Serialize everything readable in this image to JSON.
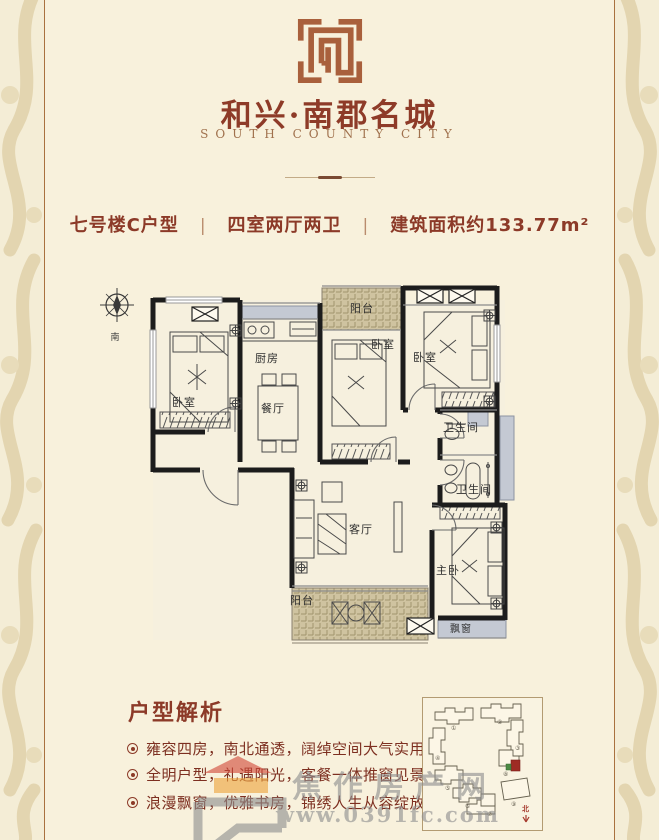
{
  "header": {
    "title": "和兴·南郡名城",
    "subtitle": "SOUTH COUNTY CITY"
  },
  "info_bar": {
    "unit": "七号楼C户型",
    "separator": "|",
    "layout": "四室两厅两卫",
    "area": "建筑面积约133.77m²"
  },
  "floor_plan": {
    "compass_label": "南",
    "rooms": [
      {
        "label": "卧室"
      },
      {
        "label": "厨房"
      },
      {
        "label": "餐厅"
      },
      {
        "label": "阳台"
      },
      {
        "label": "卧室"
      },
      {
        "label": "卧室"
      },
      {
        "label": "卫生间"
      },
      {
        "label": "卫生间"
      },
      {
        "label": "客厅"
      },
      {
        "label": "主卧"
      },
      {
        "label": "阳台"
      },
      {
        "label": "飘窗"
      }
    ]
  },
  "analysis": {
    "heading": "户型解析",
    "bullets": [
      {
        "text": "雍容四房，南北通透，阔绰空间大气实用"
      },
      {
        "text": "全明户型，礼遇阳光，客餐一体推窗见景"
      },
      {
        "text": "浪漫飘窗，优雅书房，锦绣人生从容绽放"
      }
    ]
  },
  "site_map": {
    "numbers": [
      "①",
      "②",
      "③",
      "④",
      "⑤",
      "⑥",
      "⑦",
      "⑧",
      "⑨"
    ],
    "north_label": "北"
  },
  "watermark": {
    "name": "焦作房产网",
    "url": "www.0391fc.com"
  },
  "colors": {
    "accent": "#8e3b28",
    "wall": "#1c1c1c",
    "gray_fixture": "#c4c9d3",
    "hatch_tan": "#cfc3a0",
    "seal_terracotta": "#a9603c",
    "watermark_gray": "#8f8f8f",
    "roof_red": "#d24a3a",
    "window_orange": "#eda43e"
  }
}
